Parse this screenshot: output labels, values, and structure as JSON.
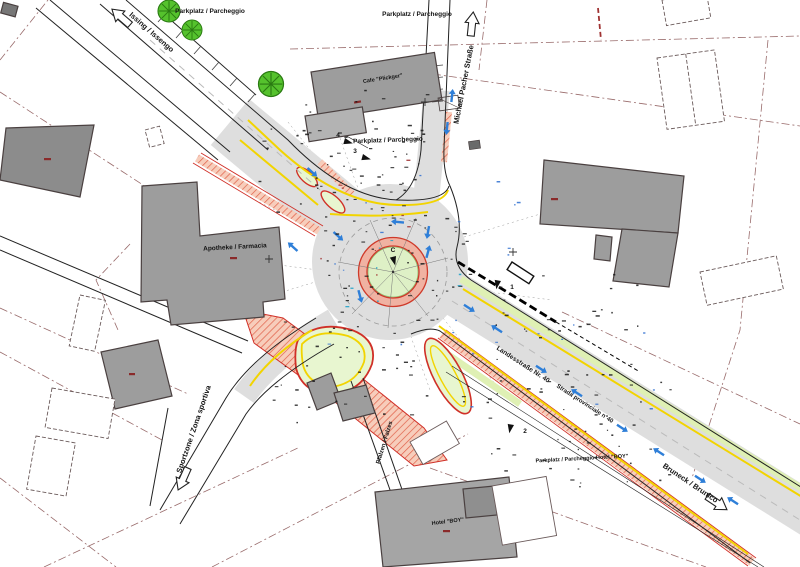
{
  "plan": {
    "title": "Roundabout traffic plan",
    "labels": {
      "issing": "Issing / Issengo",
      "michael_pacher": "Michael Pacher Straße",
      "sportzone": "Sportzone / Zona sportiva",
      "bruneck": "Bruneck / Brunico",
      "landesstrasse": "Landesstraße Nr. 40",
      "strada_provinciale": "Strada provinciale n°40",
      "pfalzen": "Pfalzen / Falzes",
      "parkplatz_top_left": "Parkplatz / Parcheggio",
      "parkplatz_top_center": "Parkplatz / Parcheggio",
      "parkplatz_mid": "Parkplatz / Parcheggio",
      "parkplatz_hotel": "Parkplatz / Parcheggio Hotel \"BOY\"",
      "cafe": "Cafe \"Plickger\"",
      "apotheke": "Apotheke / Farmacia",
      "hotel": "Hotel \"BOY\""
    },
    "markers": {
      "m1": "1",
      "m2": "2",
      "m3": "3",
      "m4": "4",
      "mc": "C"
    },
    "colors": {
      "asphalt": "#dedede",
      "building": "#9d9d9d",
      "green_island": "#def0c6",
      "apron_red": "#f0b2a2",
      "curb_yellow": "#f2d400",
      "marking_red": "#d03028",
      "tree_green": "#55c22d",
      "arrow_blue": "#2f7fd8",
      "sidewalk_salmon": "#f7cdbb",
      "parcel_line": "#996b6b"
    }
  }
}
